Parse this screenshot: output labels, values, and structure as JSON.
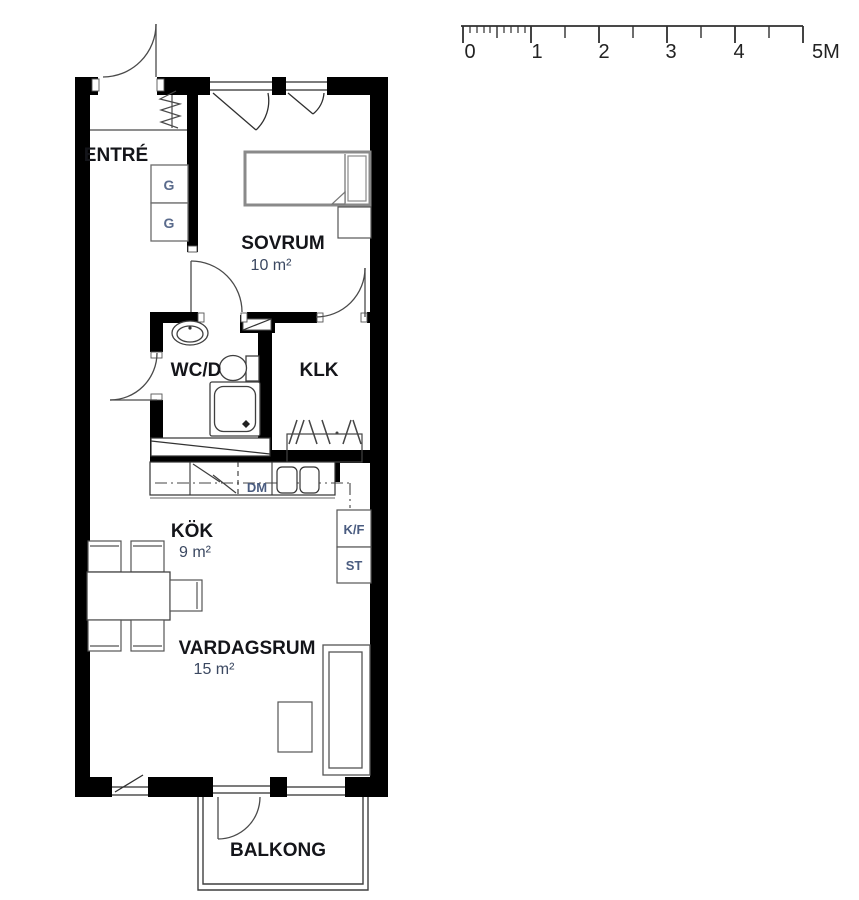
{
  "title": "apartment-floor-plan",
  "scale_bar": {
    "unit": "M",
    "labels": [
      "0",
      "1",
      "2",
      "3",
      "4",
      "5M"
    ],
    "meters_per_major_tick": 1
  },
  "rooms": [
    {
      "id": "entre",
      "name": "ENTRÉ",
      "area": ""
    },
    {
      "id": "sovrum",
      "name": "SOVRUM",
      "area": "10 m²"
    },
    {
      "id": "wcd",
      "name": "WC/D",
      "area": ""
    },
    {
      "id": "klk",
      "name": "KLK",
      "area": ""
    },
    {
      "id": "kok",
      "name": "KÖK",
      "area": "9 m²"
    },
    {
      "id": "vardagsrum",
      "name": "VARDAGSRUM",
      "area": "15 m²"
    },
    {
      "id": "balkong",
      "name": "BALKONG",
      "area": ""
    }
  ],
  "labels": {
    "closet1": "G",
    "closet2": "G",
    "dishwasher": "DM",
    "fridge_freezer": "K/F",
    "cleaning_cabinet": "ST"
  },
  "colors": {
    "wall": "#000000",
    "line": "#3f3f3f",
    "furniture": "#555555",
    "bed_outline": "#8a8a8a",
    "room_name_text": "#14151a",
    "area_text": "#3b4861",
    "small_label_text": "#4a5c80",
    "background": "#ffffff"
  }
}
